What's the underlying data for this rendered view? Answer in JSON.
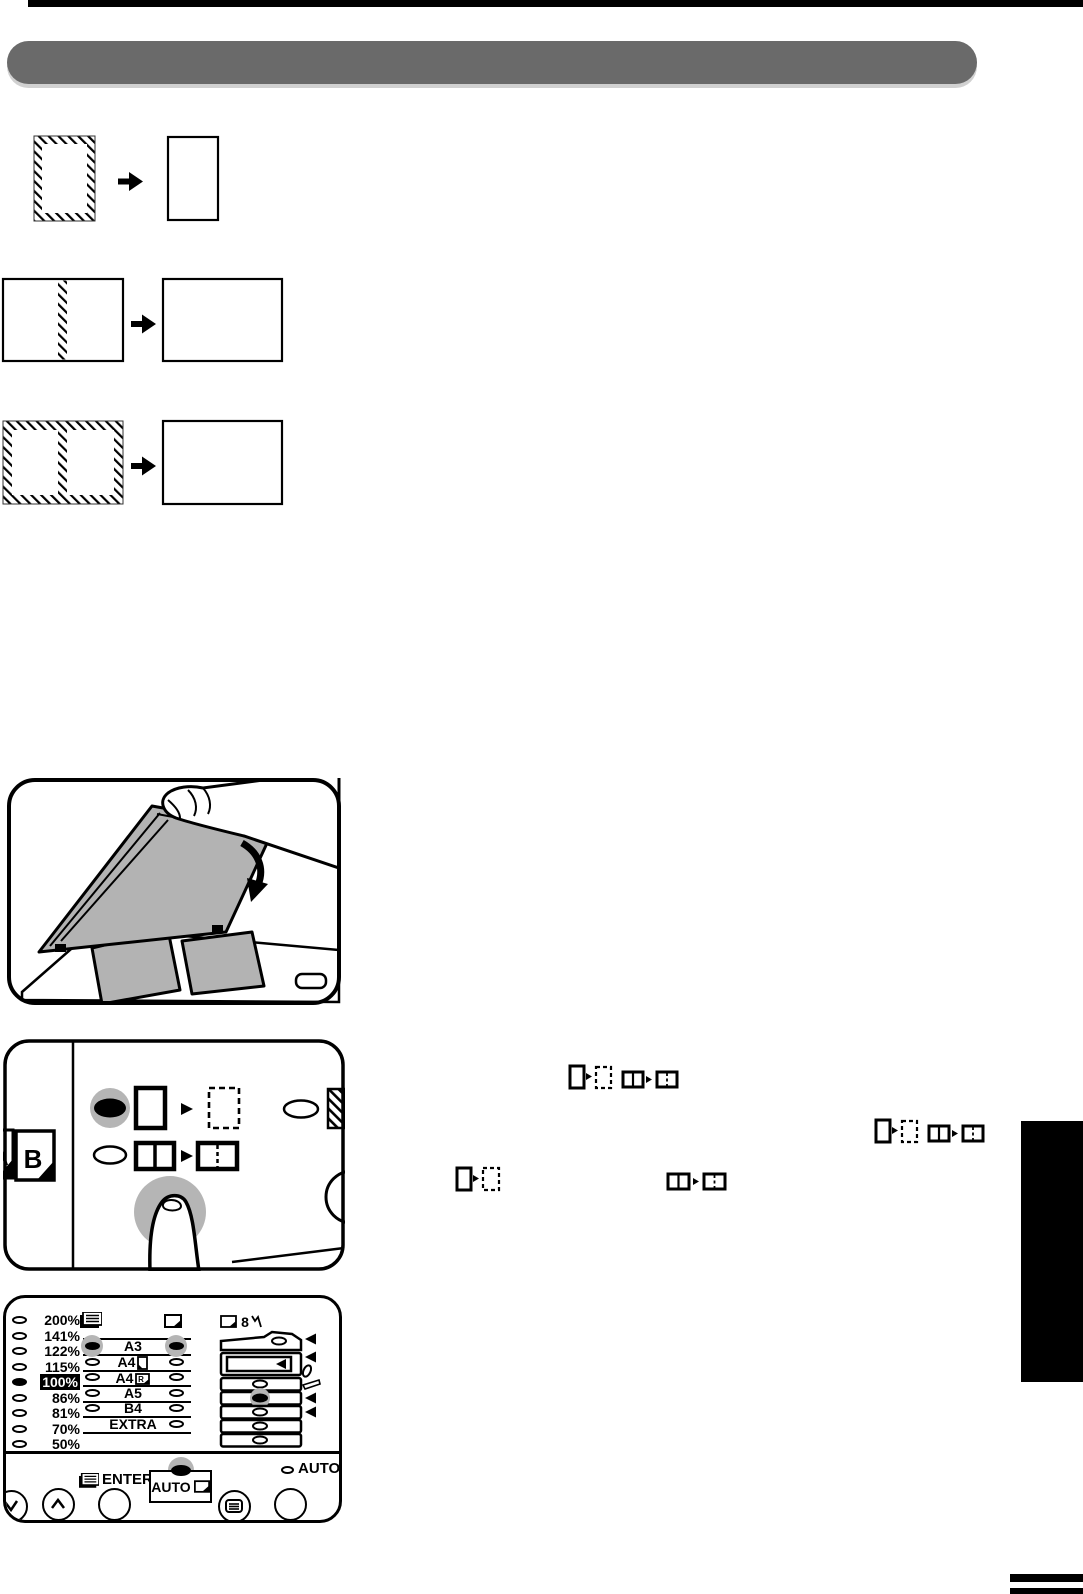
{
  "colors": {
    "header_bar": "#6a6a6a",
    "led_halo": "#b5b5b5",
    "cover_gray": "#b3b3b3",
    "accent_black": "#000000"
  },
  "transform_diagrams": [
    {
      "original_icon": "hatched-border-portrait-page",
      "result_icon": "plain-portrait-page"
    },
    {
      "original_icon": "landscape-page-center-hatch",
      "result_icon": "plain-landscape-page"
    },
    {
      "original_icon": "landscape-page-hatched-border-center-hatch",
      "result_icon": "plain-landscape-page"
    }
  ],
  "illustration": {
    "name": "closing-document-cover-over-open-book"
  },
  "mode_panel": {
    "sheet_back_letter": "A",
    "sheet_front_letter": "B",
    "row1": {
      "led": "on",
      "from_icon": "solid-portrait-page",
      "to_icon": "dashed-portrait-page"
    },
    "row2": {
      "led": "off",
      "from_icon": "book-spread",
      "to_icon": "split-page"
    },
    "side_led": "off",
    "corner_icon": "hatched-block"
  },
  "inline_icons": {
    "group1": [
      "solid-portrait-page",
      "dashed-portrait-page",
      "book-spread",
      "split-page"
    ],
    "group2": [
      "solid-portrait-page",
      "dashed-portrait-page",
      "book-spread",
      "split-page"
    ],
    "group3a": [
      "solid-portrait-page",
      "dashed-portrait-page"
    ],
    "group3b": [
      "book-spread",
      "split-page"
    ]
  },
  "ratio_panel": {
    "percent_rows": [
      {
        "label": "200%",
        "led": false
      },
      {
        "label": "141%",
        "led": false
      },
      {
        "label": "122%",
        "led": false
      },
      {
        "label": "115%",
        "led": false
      },
      {
        "label": "100%",
        "led": true,
        "selected": true
      },
      {
        "label": "86%",
        "led": false
      },
      {
        "label": "81%",
        "led": false
      },
      {
        "label": "70%",
        "led": false
      },
      {
        "label": "50%",
        "led": false
      }
    ],
    "original_icon": "original-document-icon",
    "copy_icon": "copy-paper-icon",
    "size_rows": [
      {
        "label": "A3",
        "left_led": "on",
        "right_led": "on",
        "highlight": true
      },
      {
        "label": "A4",
        "left_led": "off",
        "right_led": "off",
        "suffix_icon": "portrait-sheet-icon"
      },
      {
        "label": "A4",
        "left_led": "off",
        "right_led": "off",
        "suffix_icon": "a4r-sheet-icon"
      },
      {
        "label": "A5",
        "left_led": "off",
        "right_led": "off"
      },
      {
        "label": "B4",
        "left_led": "off",
        "right_led": "off"
      },
      {
        "label": "EXTRA",
        "left_led": null,
        "right_led": "off"
      }
    ],
    "a4r_letter": "R",
    "bypass_label": "8",
    "tray_stack": {
      "selected_tray_led": "on",
      "arrow_markers": 4
    },
    "enter_label": "ENTER",
    "auto_button_label": "AUTO",
    "auto_ratio_label": "AUTO %"
  }
}
